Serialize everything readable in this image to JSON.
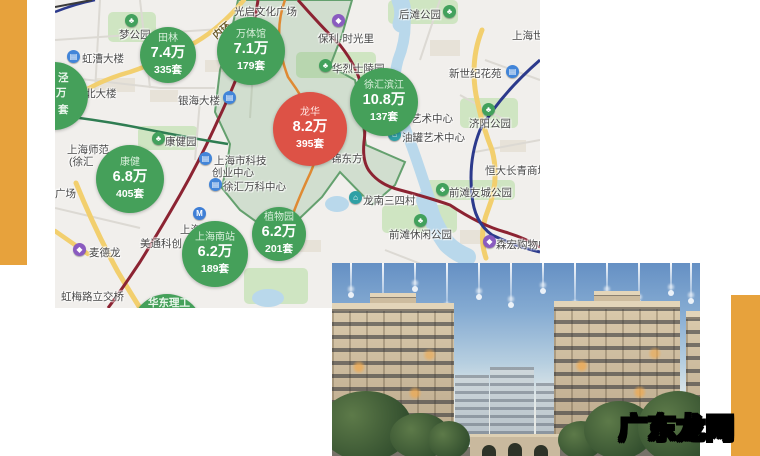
{
  "decor": {
    "bar_color": "#e7a23c"
  },
  "watermark": {
    "text": "广东龙网"
  },
  "map": {
    "icon_glyphs": {
      "park": "♣",
      "building": "▤",
      "metro": "M",
      "mall": "◆",
      "house": "⌂"
    },
    "circles": [
      {
        "name": "田林",
        "price": "7.4万",
        "count": "335套",
        "color": "green",
        "x": 113,
        "y": 55,
        "r": 28
      },
      {
        "name": "万体馆",
        "price": "7.1万",
        "count": "179套",
        "color": "green",
        "x": 196,
        "y": 51,
        "r": 34
      },
      {
        "name": "龙华",
        "price": "8.2万",
        "count": "395套",
        "color": "red",
        "x": 255,
        "y": 129,
        "r": 37
      },
      {
        "name": "徐汇滨江",
        "price": "10.8万",
        "count": "137套",
        "color": "green",
        "x": 329,
        "y": 102,
        "r": 34
      },
      {
        "name": "康健",
        "price": "6.8万",
        "count": "405套",
        "color": "green",
        "x": 75,
        "y": 179,
        "r": 34
      },
      {
        "name": "上海南站",
        "price": "6.2万",
        "count": "189套",
        "color": "green",
        "x": 160,
        "y": 254,
        "r": 33
      },
      {
        "name": "植物园",
        "price": "6.2万",
        "count": "201套",
        "color": "green",
        "x": 224,
        "y": 234,
        "r": 27
      },
      {
        "color": "green",
        "x": -1,
        "y": 96,
        "r": 34
      },
      {
        "color": "green",
        "x": 112,
        "y": 330,
        "r": 36
      }
    ],
    "fragments": [
      {
        "t": "泾",
        "x": 3,
        "y": 70
      },
      {
        "t": "万",
        "x": 1,
        "y": 85
      },
      {
        "t": "套",
        "x": 3,
        "y": 102
      },
      {
        "t": "华东理工",
        "x": 93,
        "y": 295
      }
    ],
    "labels": [
      {
        "t": "梦公园",
        "x": 64,
        "y": 27,
        "icon": "park",
        "ix": 70,
        "iy": 14
      },
      {
        "t": "虹漕大楼",
        "x": 27,
        "y": 51,
        "icon": "building",
        "ix": 12,
        "iy": 50
      },
      {
        "t": "北大楼",
        "x": 30,
        "y": 86
      },
      {
        "t": "银海大楼",
        "x": 123,
        "y": 93,
        "icon": "building",
        "ix": 168,
        "iy": 91
      },
      {
        "t": "光启文化广场",
        "x": 179,
        "y": 4
      },
      {
        "t": "内环",
        "x": 156,
        "y": 22,
        "cls": "rot"
      },
      {
        "t": "保利·时光里",
        "x": 263,
        "y": 31,
        "icon": "mall",
        "ix": 277,
        "iy": 14
      },
      {
        "t": "华烈士陵园",
        "x": 277,
        "y": 61,
        "icon": "park",
        "ix": 264,
        "iy": 59
      },
      {
        "t": "后滩公园",
        "x": 344,
        "y": 7,
        "icon": "park",
        "ix": 388,
        "iy": 5
      },
      {
        "t": "上海世",
        "x": 457,
        "y": 28
      },
      {
        "t": "新世纪花苑",
        "x": 394,
        "y": 66,
        "icon": "building",
        "ix": 451,
        "iy": 65
      },
      {
        "t": "济阳公园",
        "x": 414,
        "y": 116,
        "icon": "park",
        "ix": 427,
        "iy": 103
      },
      {
        "t": "艺术中心",
        "x": 356,
        "y": 111
      },
      {
        "t": "油罐艺术中心",
        "x": 347,
        "y": 130,
        "icon": "house",
        "ix": 333,
        "iy": 128
      },
      {
        "t": "恒大长青商城",
        "x": 430,
        "y": 163
      },
      {
        "t": "前滩友城公园",
        "x": 394,
        "y": 185,
        "icon": "park",
        "ix": 381,
        "iy": 183
      },
      {
        "t": "龙南三四村",
        "x": 308,
        "y": 193,
        "icon": "house",
        "ix": 294,
        "iy": 191
      },
      {
        "t": "前滩休闲公园",
        "x": 334,
        "y": 227,
        "icon": "park",
        "ix": 359,
        "iy": 214
      },
      {
        "t": "森宏购物中心",
        "x": 441,
        "y": 237,
        "icon": "mall",
        "ix": 428,
        "iy": 235
      },
      {
        "t": "锦东方",
        "x": 276,
        "y": 151
      },
      {
        "t": "康健园",
        "x": 110,
        "y": 134,
        "icon": "park",
        "ix": 97,
        "iy": 132
      },
      {
        "t": "上海师范",
        "x": 12,
        "y": 142
      },
      {
        "t": "(徐汇",
        "x": 14,
        "y": 154
      },
      {
        "t": "广场",
        "x": 0,
        "y": 186
      },
      {
        "t": "上海市科技",
        "x": 159,
        "y": 153,
        "icon": "building",
        "ix": 144,
        "iy": 152
      },
      {
        "t": "创业中心",
        "x": 157,
        "y": 165
      },
      {
        "t": "徐汇万科中心",
        "x": 168,
        "y": 179,
        "icon": "building",
        "ix": 154,
        "iy": 178
      },
      {
        "t": "上海南站",
        "x": 125,
        "y": 222,
        "icon": "metro",
        "ix": 138,
        "iy": 207
      },
      {
        "t": "美通科创",
        "x": 85,
        "y": 236
      },
      {
        "t": "麦德龙",
        "x": 34,
        "y": 245,
        "icon": "mall",
        "ix": 18,
        "iy": 243
      },
      {
        "t": "虹梅路立交桥",
        "x": 6,
        "y": 289
      }
    ]
  }
}
